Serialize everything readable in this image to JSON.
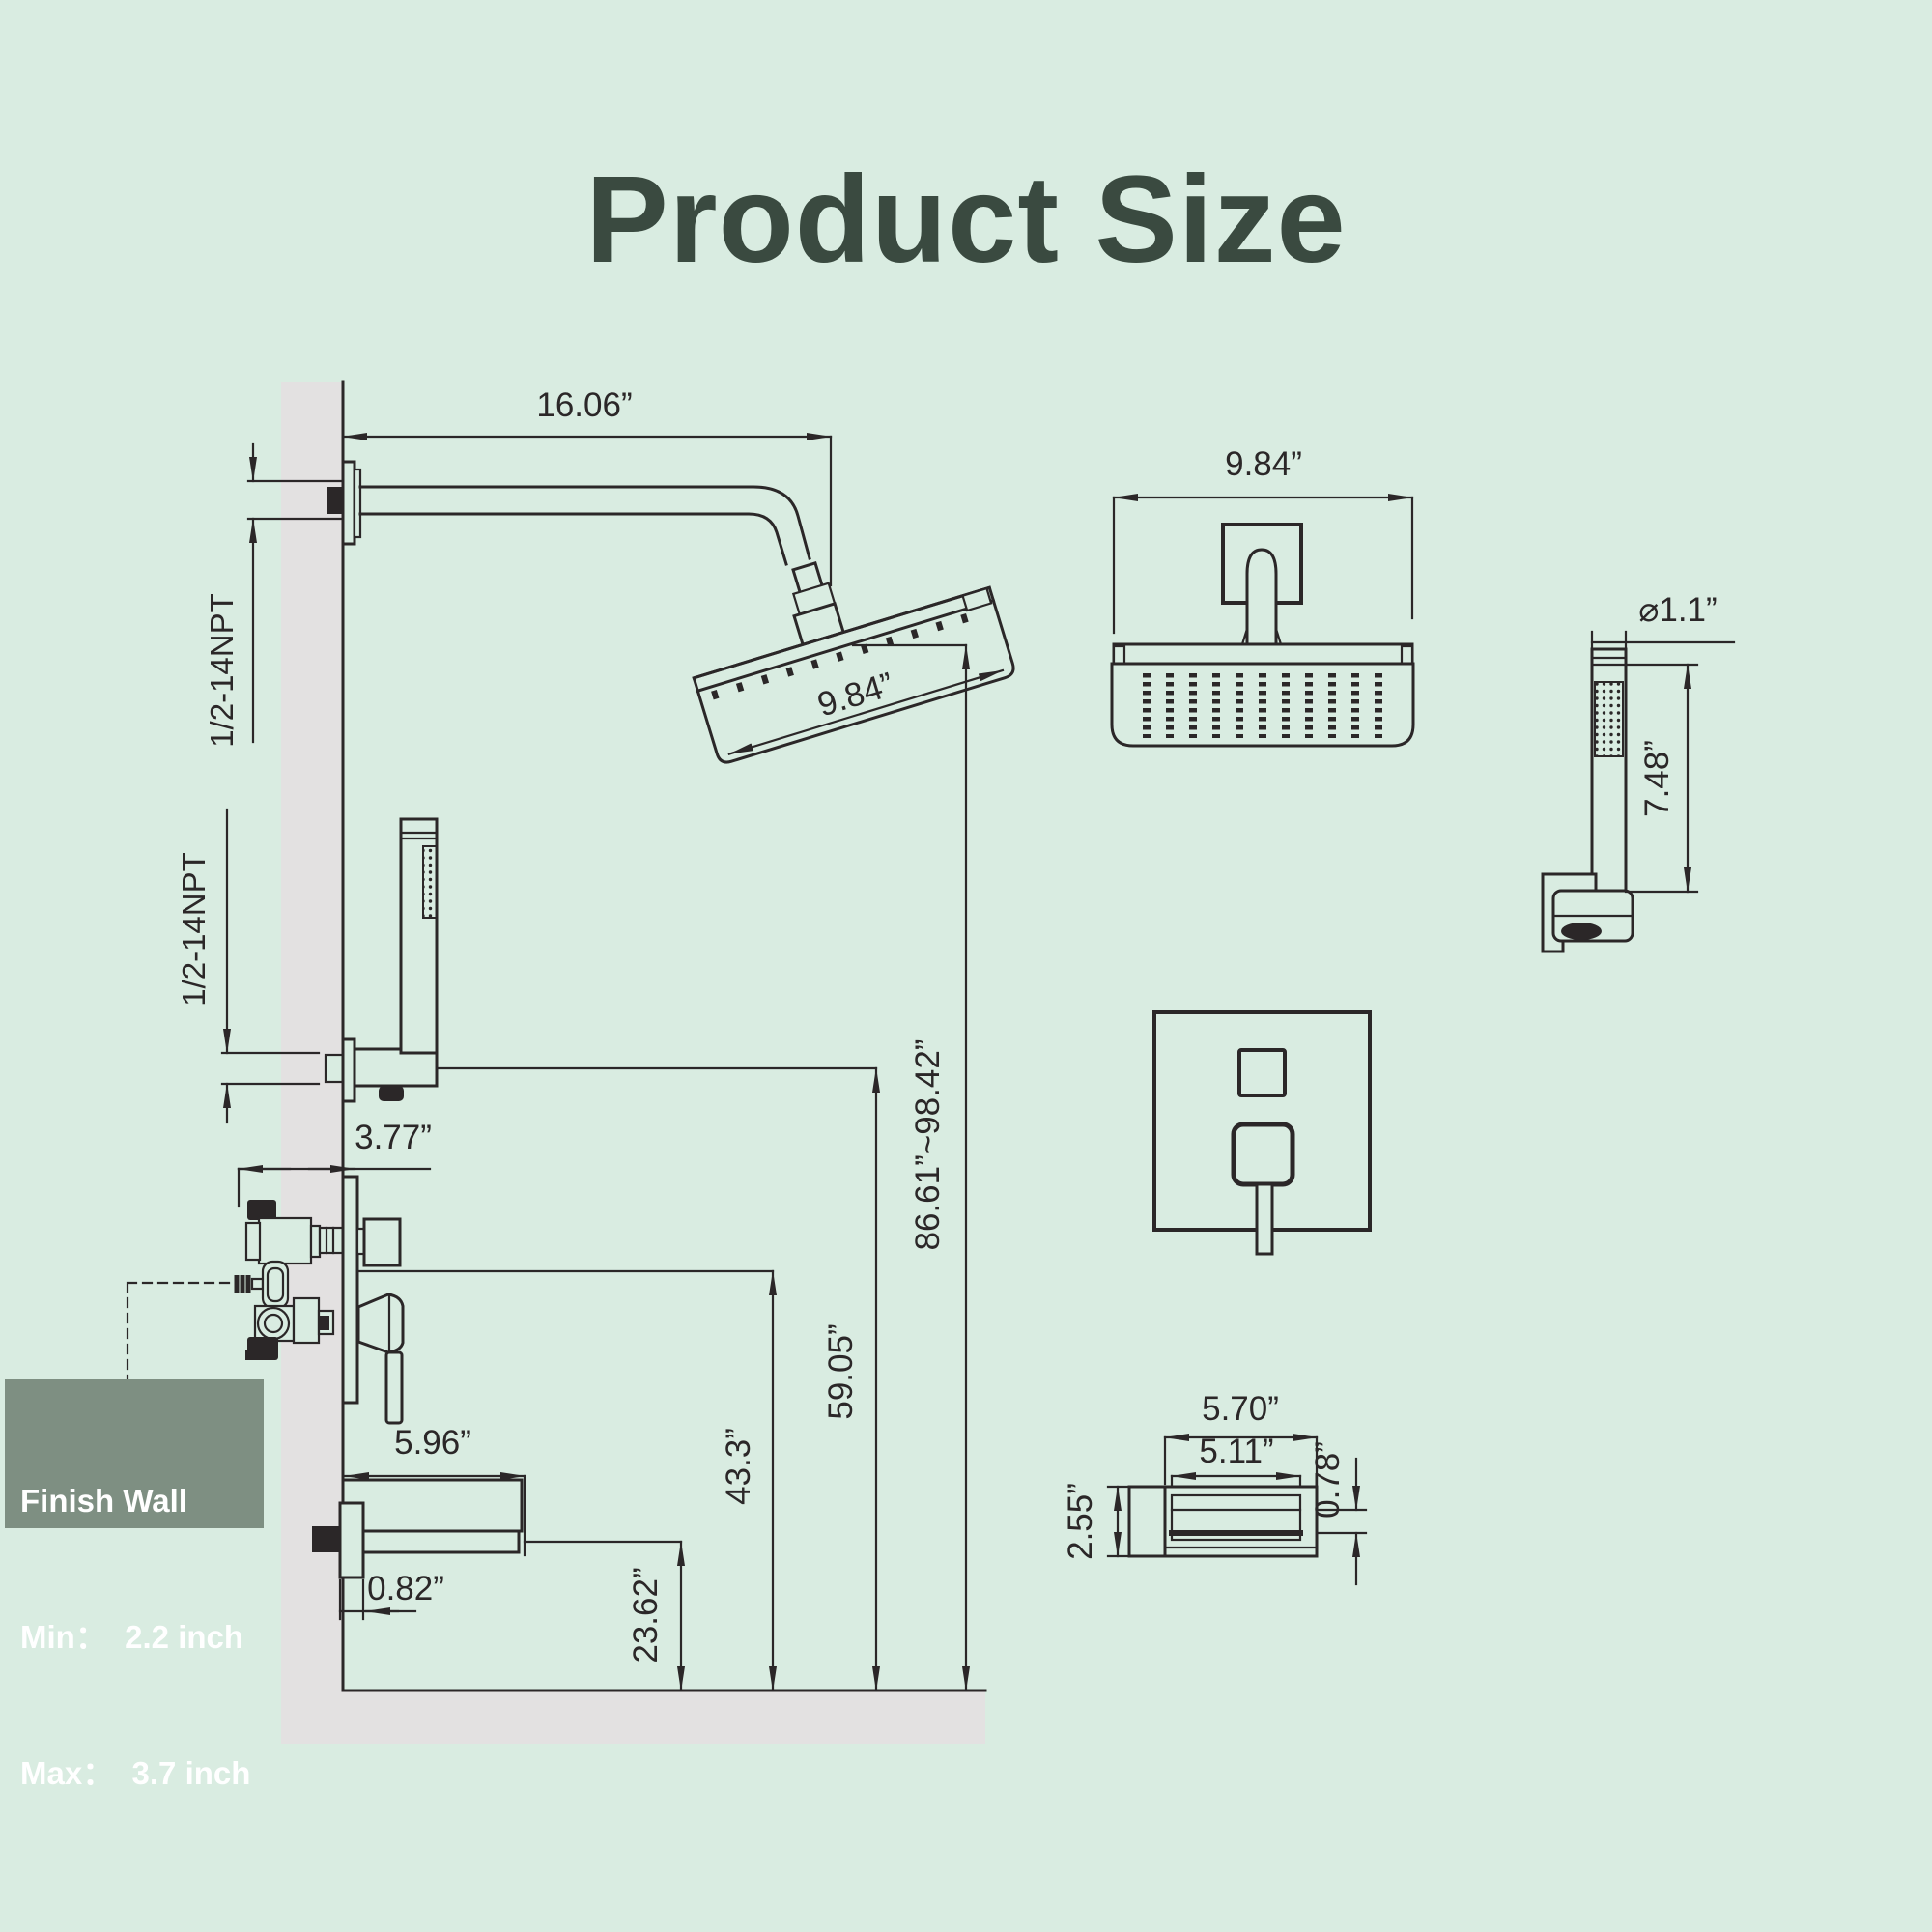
{
  "title": "Product Size",
  "colors": {
    "background": "#d9ece1",
    "ink": "#2b2728",
    "wall": "#e3e1e1",
    "box_bg": "#7e8f82",
    "box_text": "#ffffff",
    "title_color": "#3a4a40"
  },
  "side_view": {
    "dim_arm_length": "16.06”",
    "npt_top_label": "1/2-14NPT",
    "npt_mid_label": "1/2-14NPT",
    "dim_head_width": "9.84”",
    "dim_valve_depth": "3.77”",
    "dim_spout_length": "5.96”",
    "dim_spout_wall": "0.82”",
    "dim_spout_floor": "23.62”",
    "dim_valve_floor": "43.3”",
    "dim_holder_floor": "59.05”",
    "dim_head_floor": "86.61”~98.42”"
  },
  "finish_wall_note": {
    "line1": "Finish Wall",
    "line2": "Min：  2.2 inch",
    "line3": "Max：  3.7 inch"
  },
  "front_views": {
    "dim_head_width": "9.84”",
    "dim_handheld_diameter": "⌀1.1”",
    "dim_handheld_length": "7.48”",
    "dim_spout_length": "5.70”",
    "dim_spout_inner": "5.11”",
    "dim_spout_lip": "0.78”",
    "dim_spout_height": "2.55”"
  }
}
